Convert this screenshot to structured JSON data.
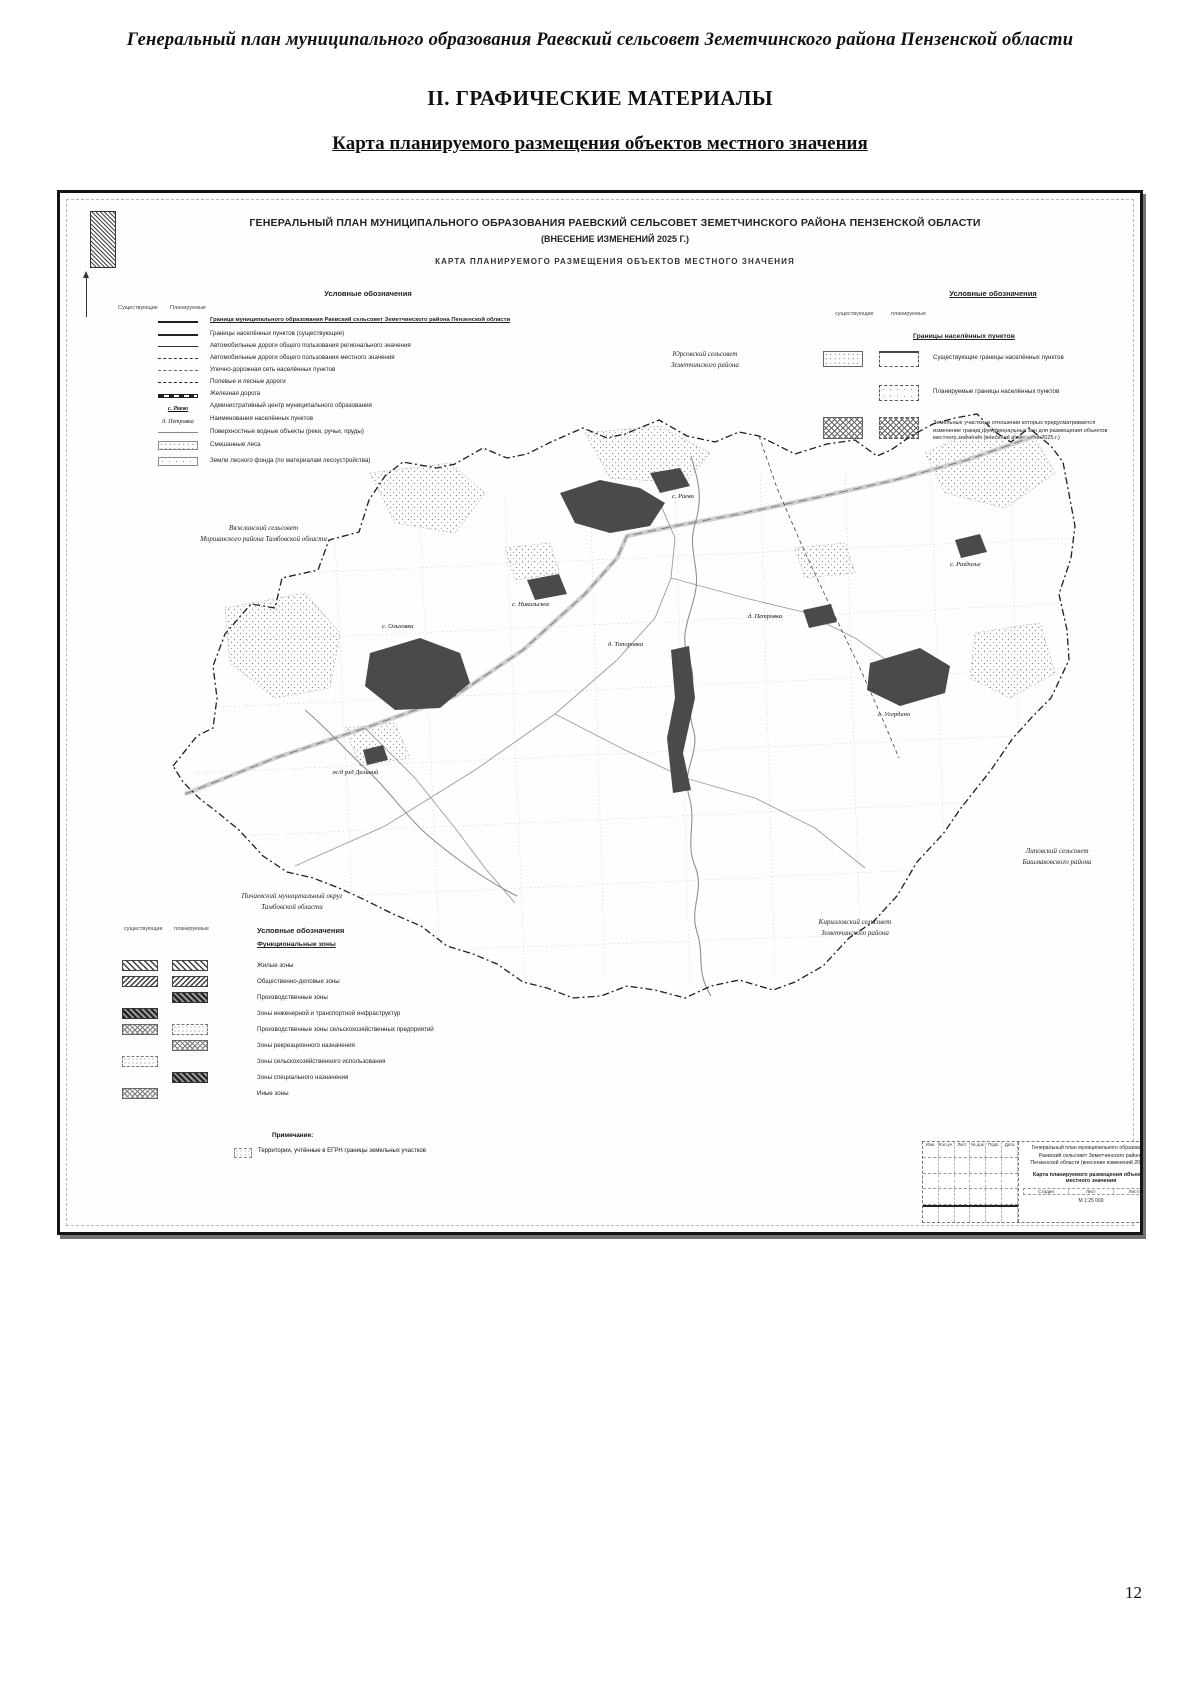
{
  "page": {
    "header": "Генеральный план муниципального образования Раевский сельсовет Земетчинского района Пензенской области",
    "section_title": "II. ГРАФИЧЕСКИЕ МАТЕРИАЛЫ",
    "map_caption": "Карта планируемого размещения объектов местного значения",
    "page_number": "12"
  },
  "map": {
    "title_line1": "ГЕНЕРАЛЬНЫЙ ПЛАН МУНИЦИПАЛЬНОГО ОБРАЗОВАНИЯ РАЕВСКИЙ СЕЛЬСОВЕТ ЗЕМЕТЧИНСКОГО РАЙОНА ПЕНЗЕНСКОЙ ОБЛАСТИ",
    "title_line2": "(ВНЕСЕНИЕ ИЗМЕНЕНИЙ 2025 Г.)",
    "title_line3": "КАРТА ПЛАНИРУЕМОГО РАЗМЕЩЕНИЯ ОБЪЕКТОВ МЕСТНОГО ЗНАЧЕНИЯ"
  },
  "legend_left": {
    "title": "Условные обозначения",
    "col_existing": "Существующие",
    "col_planned": "Планируемые",
    "rows": [
      {
        "label": "Граница муниципального образования Раевский сельсовет Земетчинского района Пензенской области"
      },
      {
        "label": "Границы населённых пунктов (существующие)"
      },
      {
        "label": "Автомобильные дороги общего пользования регионального значения"
      },
      {
        "label": "Автомобильные дороги общего пользования местного значения"
      },
      {
        "label": "Улично-дорожная сеть населённых пунктов"
      },
      {
        "label": "Полевые и лесные дороги"
      },
      {
        "label": "Железная дорога"
      },
      {
        "sample": "с. Раево",
        "label": "Административный центр муниципального образования"
      },
      {
        "sample": "д. Петровка",
        "label": "Наименования населённых пунктов"
      },
      {
        "label": "Поверхностные водные объекты (реки, ручьи, пруды)"
      },
      {
        "label": "Смешанные леса"
      },
      {
        "label": "Земли лесного фонда (по материалам лесоустройства)"
      }
    ]
  },
  "legend_right": {
    "title": "Условные обозначения",
    "col_existing": "существующие",
    "col_planned": "планируемые",
    "subheader": "Границы населённых пунктов",
    "rows": [
      {
        "label": "Существующие границы населённых пунктов"
      },
      {
        "label": "Планируемые границы населённых пунктов"
      },
      {
        "label": "Земельные участки, в отношении которых предусматривается изменение границ функциональных зон для размещения объектов местного значения (внесение изменений 2025 г.)"
      }
    ]
  },
  "legend_zones": {
    "col_existing": "существующие",
    "col_planned": "планируемые",
    "title": "Условные обозначения",
    "subheader": "Функциональные зоны",
    "rows": [
      {
        "label": "Жилые зоны"
      },
      {
        "label": "Общественно-деловые зоны"
      },
      {
        "label": "Производственные зоны"
      },
      {
        "label": "Зоны инженерной и транспортной инфраструктур"
      },
      {
        "label": "Производственные зоны сельскохозяйственных предприятий"
      },
      {
        "label": "Зоны рекреационного назначения"
      },
      {
        "label": "Зоны сельскохозяйственного использования"
      },
      {
        "label": "Зоны специального назначения"
      },
      {
        "label": "Иные зоны"
      }
    ],
    "note_title": "Примечание:",
    "note_text": "Территории, учтённые в ЕГРН границы земельных участков"
  },
  "neighbors": [
    {
      "line1": "Юрсовский сельсовет",
      "line2": "Земетчинского района"
    },
    {
      "line1": "Вяжлинский сельсовет",
      "line2": "Моршанского района Тамбовской области"
    },
    {
      "line1": "Пичаевский муниципальный округ",
      "line2": "Тамбовской области"
    },
    {
      "line1": "Кирилловский сельсовет",
      "line2": "Земетчинского района"
    },
    {
      "line1": "Липовский сельсовет",
      "line2": "Башмаковского района"
    }
  ],
  "settlements": [
    {
      "name": "с. Раево"
    },
    {
      "name": "с. Никольское"
    },
    {
      "name": "д. Топоровка"
    },
    {
      "name": "д. Петровка"
    },
    {
      "name": "с. Ольховка"
    },
    {
      "name": "с. Усердино"
    },
    {
      "name": "с. Раздолье"
    },
    {
      "name": "ж/д рзд Дальний"
    }
  ],
  "stamp": {
    "header_cells": [
      "Изм.",
      "Кол.уч.",
      "Лист",
      "№ док.",
      "Подп.",
      "Дата"
    ],
    "title_line1": "Генеральный план муниципального образования",
    "title_line2": "Раевский сельсовет Земетчинского района",
    "title_line3": "Пензенской области (внесение изменений 2025 г.)",
    "map_name": "Карта планируемого размещения объектов местного значения",
    "mini_cells": [
      "Стадия",
      "Лист",
      "Листов"
    ],
    "scale": "М 1:25 000"
  },
  "colors": {
    "ink": "#1a1a1a",
    "urban": "#4a4a4a",
    "frame": "#151515",
    "grid": "#bdbdbd"
  }
}
